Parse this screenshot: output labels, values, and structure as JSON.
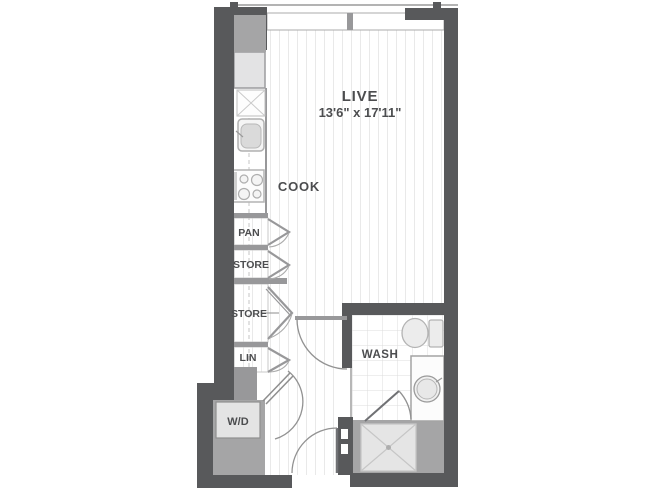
{
  "floor_plan": {
    "rooms": {
      "live": {
        "label": "LIVE",
        "dimensions": "13'6\" x 17'11\""
      },
      "cook": {
        "label": "COOK"
      },
      "wash": {
        "label": "WASH"
      }
    },
    "closets": {
      "pantry": {
        "label": "PAN"
      },
      "storage_upper": {
        "label": "STORE"
      },
      "storage_lower": {
        "label": "STORE"
      },
      "linen": {
        "label": "LIN"
      },
      "washer_dryer": {
        "label": "W/D"
      }
    },
    "colors": {
      "wall_dark": "#58595b",
      "wall_light": "#98989a",
      "mass_gray": "#a5a5a6",
      "appliance_fill": "#e3e3e4",
      "floor_plank_line": "#e9e9e9",
      "tile_line": "#d9d9d9",
      "door_arc": "#929292",
      "label_text": "#4c4d4f"
    }
  }
}
